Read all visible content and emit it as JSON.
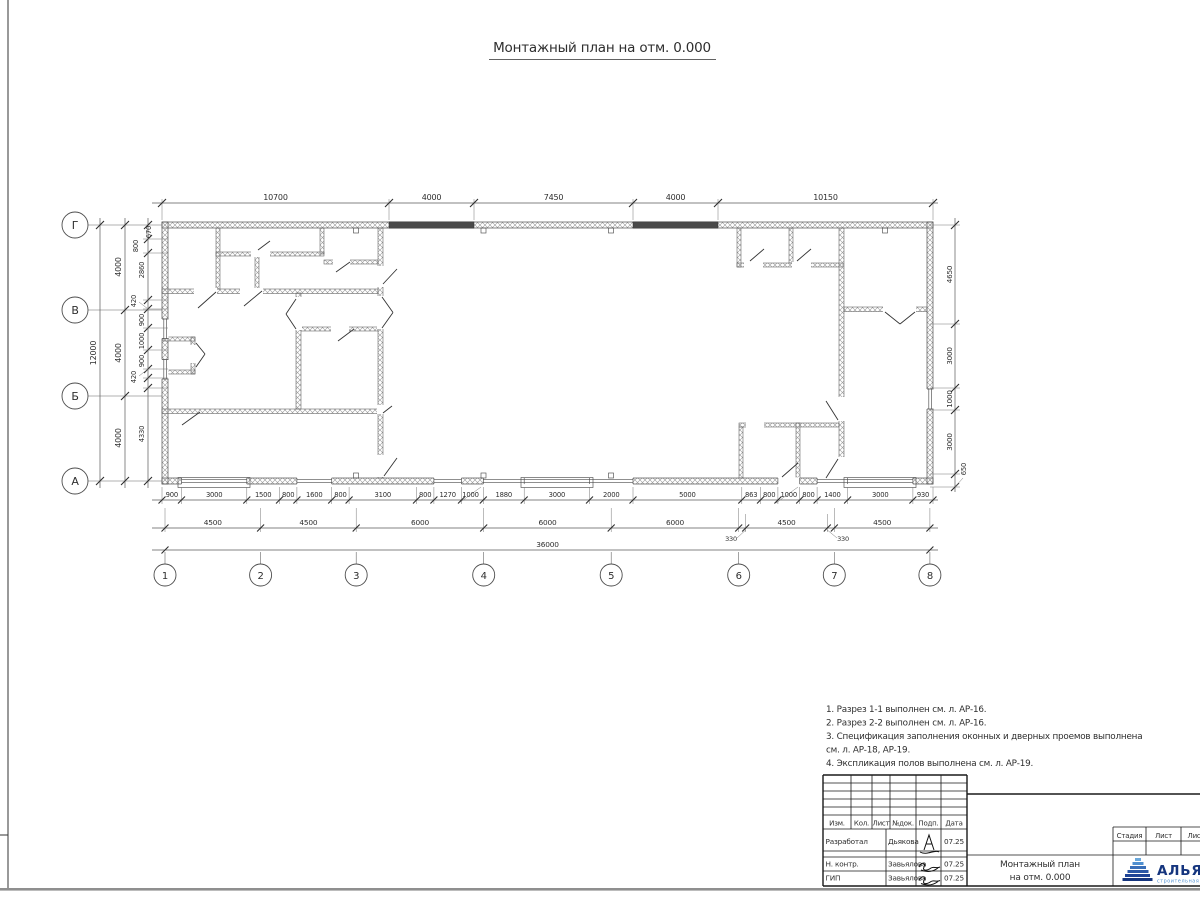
{
  "sheet": {
    "title": "Монтажный план на отм. 0.000",
    "notes": [
      "1. Разрез 1-1 выполнен см. л. АР-16.",
      "2. Разрез 2-2 выполнен см. л. АР-16.",
      "3. Спецификация заполнения оконных и дверных проемов выполнена",
      "см. л. АР-18, АР-19.",
      "4. Экспликация полов выполнена см. л. АР-19."
    ]
  },
  "axes": {
    "rows": [
      "Г",
      "В",
      "Б",
      "А"
    ],
    "cols": [
      "1",
      "2",
      "3",
      "4",
      "5",
      "6",
      "7",
      "8"
    ]
  },
  "dims": {
    "top": [
      "10700",
      "4000",
      "7450",
      "4000",
      "10150"
    ],
    "left_total": "12000",
    "left_bays": [
      "4000",
      "4000",
      "4000"
    ],
    "left_inner": [
      "670",
      "800",
      "2860",
      "420",
      "900",
      "1000",
      "900",
      "420",
      "4330"
    ],
    "right": [
      "4650",
      "3000",
      "1000",
      "3000",
      "650"
    ],
    "bottom_row1": [
      "900",
      "3000",
      "1500",
      "800",
      "1600",
      "800",
      "3100",
      "800",
      "1270",
      "1000",
      "1880",
      "3000",
      "2000",
      "5000",
      "863",
      "800",
      "1000",
      "800",
      "1400",
      "3000",
      "930"
    ],
    "bottom_row2": [
      "4500",
      "4500",
      "6000",
      "6000",
      "6000",
      "4500",
      "4500"
    ],
    "row2_extra": [
      "330",
      "330"
    ],
    "bottom_total": "36000"
  },
  "titleblock": {
    "header": [
      "Изм.",
      "Кол.",
      "Лист",
      "№док.",
      "Подп.",
      "Дата"
    ],
    "rows": [
      {
        "role": "Разработал",
        "name": "Дьякова",
        "date": "07.25"
      },
      {
        "role": "Н. контр.",
        "name": "Завьялова",
        "date": "07.25"
      },
      {
        "role": "ГИП",
        "name": "Завьялова",
        "date": "07.25"
      }
    ],
    "doc_title_line1": "Монтажный план",
    "doc_title_line2": "на отм. 0.000",
    "stage": [
      "Стадия",
      "Лист",
      "Лист"
    ],
    "logo_text": "АЛЬЯНС",
    "logo_subtext": "строительная компания",
    "logo_color": "#15357e",
    "logo_light": "#4f8fd0"
  }
}
